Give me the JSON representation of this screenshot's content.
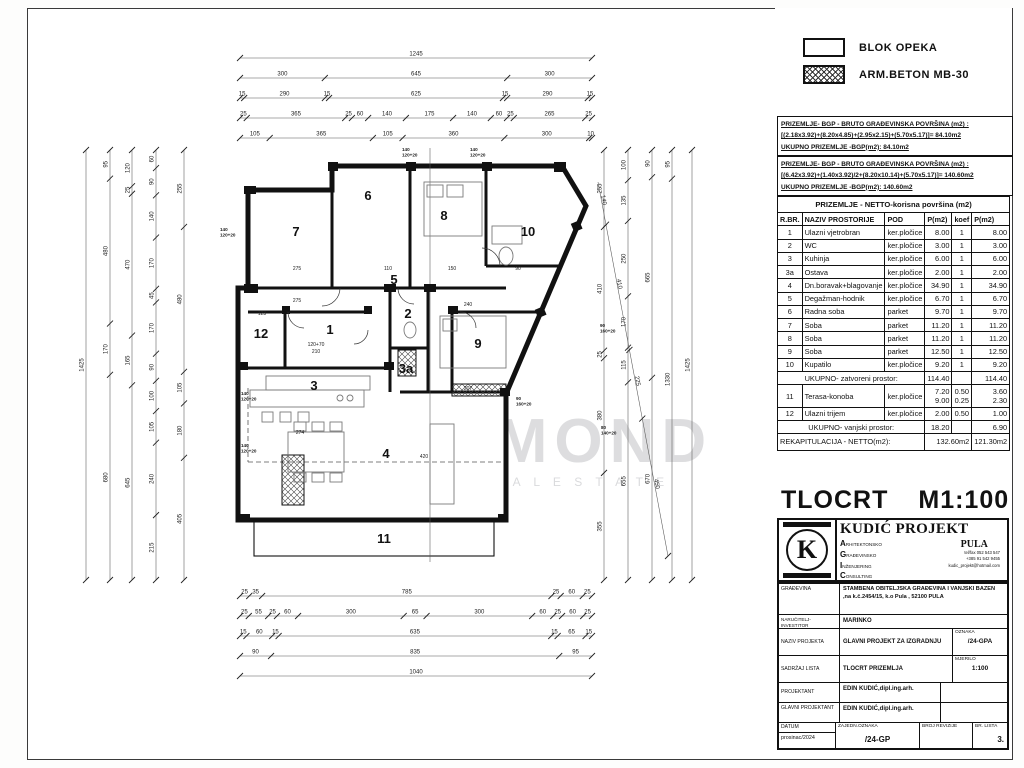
{
  "legend": {
    "items": [
      {
        "label": "BLOK OPEKA",
        "swatch": "plain"
      },
      {
        "label": "ARM.BETON  MB-30",
        "swatch": "hatch"
      }
    ]
  },
  "bgp1": {
    "l1": "PRIZEMLJE- BGP - BRUTO GRAĐEVINSKA POVRŠINA (m2) :",
    "l2": "[(2.18x3.92)+(8.20x4.85)+(2.95x2.15)+(5.70x5.17)]= 84.10m2",
    "l3": "UKUPNO PRIZEMLJE -BGP(m2):          84.10m2"
  },
  "bgp2": {
    "l1": "PRIZEMLJE- BGP - BRUTO GRAĐEVINSKA POVRŠINA (m2) :",
    "l2": "[(6.42x3.92)+(1.40x3.92)/2+(8.20x10.14)+(5.70x5.17)]= 140.60m2",
    "l3": "UKUPNO PRIZEMLJE -BGP(m2):          140.60m2"
  },
  "area_table": {
    "title": "PRIZEMLJE - NETTO-korisna površina (m2)",
    "columns": [
      "R.BR.",
      "NAZIV PROSTORIJE",
      "POD",
      "P(m2)",
      "koef",
      "P(m2)"
    ],
    "rows": [
      [
        "1",
        "Ulazni vjetrobran",
        "ker.pločice",
        "8.00",
        "1",
        "8.00"
      ],
      [
        "2",
        "WC",
        "ker.pločice",
        "3.00",
        "1",
        "3.00"
      ],
      [
        "3",
        "Kuhinja",
        "ker.pločice",
        "6.00",
        "1",
        "6.00"
      ],
      [
        "3a",
        "Ostava",
        "ker.pločice",
        "2.00",
        "1",
        "2.00"
      ],
      [
        "4",
        "Dn.boravak+blagovanje",
        "ker.pločice",
        "34.90",
        "1",
        "34.90"
      ],
      [
        "5",
        "Degažman-hodnik",
        "ker.pločice",
        "6.70",
        "1",
        "6.70"
      ],
      [
        "6",
        "Radna soba",
        "parket",
        "9.70",
        "1",
        "9.70"
      ],
      [
        "7",
        "Soba",
        "parket",
        "11.20",
        "1",
        "11.20"
      ],
      [
        "8",
        "Soba",
        "parket",
        "11.20",
        "1",
        "11.20"
      ],
      [
        "9",
        "Soba",
        "parket",
        "12.50",
        "1",
        "12.50"
      ],
      [
        "10",
        "Kupatilo",
        "ker.pločice",
        "9.20",
        "1",
        "9.20"
      ]
    ],
    "subtotal_closed": {
      "label": "UKUPNO- zatvoreni prostor:",
      "p": "114.40",
      "total": "114.40"
    },
    "outdoor_rows": [
      [
        "11",
        "Terasa-konoba",
        "ker.pločice",
        "7.20\n9.00",
        "0.50\n0.25",
        "3.60\n2.30"
      ],
      [
        "12",
        "Ulazni trijem",
        "ker.pločice",
        "2.00",
        "0.50",
        "1.00"
      ]
    ],
    "subtotal_outdoor": {
      "label": "UKUPNO- vanjski prostor:",
      "p": "18.20",
      "total": "6.90"
    },
    "recap": {
      "label": "REKAPITULACIJA - NETTO(m2):",
      "p": "132.60m2",
      "total": "121.30m2"
    }
  },
  "drawing_title": {
    "name": "TLOCRT",
    "scale": "M1:100"
  },
  "stamp": {
    "company": "KUDIĆ PROJEKT",
    "city": "PULA",
    "agic": [
      [
        "A",
        "RHITEKTONSKO"
      ],
      [
        "G",
        "RAĐEVINSKO"
      ],
      [
        "I",
        "NŽENJERING"
      ],
      [
        "C",
        "ONSULTING"
      ]
    ],
    "note1": "d.o.o. za projektiranje,",
    "note2": "nadzor i consulting",
    "contact": [
      "tel/fax 052 543 547",
      "+385 91 542 9455",
      "kudic_projekt@hotmail.com"
    ]
  },
  "title_block": {
    "rows": [
      {
        "label": "GRAĐEVINA",
        "value": "STAMBENA OBITELJSKA  GRAĐEVINA I VANJSKI BAZEN ,na k.č.2454/15, k.o Pula , 52100 PULA"
      },
      {
        "label": "NARUČITELJ-INVESTITOR",
        "value": "MARINKO"
      },
      {
        "label": "NAZIV PROJEKTA",
        "value": "GLAVNI PROJEKT ZA IZGRADNJU",
        "sub_label": "OZNAKA",
        "sub_value": "/24-GPA"
      },
      {
        "label": "SADRŽAJ LISTA",
        "value": "TLOCRT PRIZEMLJA",
        "sub_label": "MJERILO",
        "sub_value": "1:100"
      },
      {
        "label": "PROJEKTANT",
        "value": "EDIN KUDIĆ,dipl.ing.arh."
      },
      {
        "label": "GLAVNI PROJEKTANT",
        "value": "EDIN KUDIĆ,dipl.ing.arh."
      }
    ],
    "footer": {
      "label": "DATUM",
      "value": "prosinac/2024",
      "c1_label": "ZAJEDN.OZNAKA",
      "c1_value": "/24-GP",
      "c2_label": "BROJ REVIZIJE",
      "c2_value": "",
      "c3_label": "BR. LISTA",
      "c3_value": "3."
    }
  },
  "plan": {
    "watermark": "DIAMOND",
    "watermark_sub": "R E A L   E S T A T E",
    "rooms": [
      {
        "t": "7",
        "x": 296,
        "y": 236
      },
      {
        "t": "6",
        "x": 368,
        "y": 200
      },
      {
        "t": "8",
        "x": 444,
        "y": 220
      },
      {
        "t": "10",
        "x": 528,
        "y": 236
      },
      {
        "t": "5",
        "x": 394,
        "y": 284
      },
      {
        "t": "12",
        "x": 261,
        "y": 338
      },
      {
        "t": "1",
        "x": 330,
        "y": 334
      },
      {
        "t": "2",
        "x": 408,
        "y": 318
      },
      {
        "t": "9",
        "x": 478,
        "y": 348
      },
      {
        "t": "3a",
        "x": 406,
        "y": 373
      },
      {
        "t": "3",
        "x": 314,
        "y": 390
      },
      {
        "t": "4",
        "x": 386,
        "y": 458
      },
      {
        "t": "11",
        "x": 384,
        "y": 543
      }
    ],
    "window_labels": [
      {
        "l1": "140",
        "l2": "120+20",
        "x": 220,
        "y": 231
      },
      {
        "l1": "140",
        "l2": "120+20",
        "x": 241,
        "y": 395
      },
      {
        "l1": "140",
        "l2": "120+20",
        "x": 241,
        "y": 447
      },
      {
        "l1": "90",
        "l2": "160+20",
        "x": 600,
        "y": 327
      },
      {
        "l1": "80",
        "l2": "140+20",
        "x": 601,
        "y": 429
      },
      {
        "l1": "90",
        "l2": "160+20",
        "x": 516,
        "y": 400
      },
      {
        "l1": "140",
        "l2": "120+20",
        "x": 402,
        "y": 151
      },
      {
        "l1": "140",
        "l2": "120+20",
        "x": 470,
        "y": 151
      }
    ],
    "notes": [
      {
        "t": "275",
        "x": 297,
        "y": 270
      },
      {
        "t": "275",
        "x": 297,
        "y": 302
      },
      {
        "t": "110",
        "x": 388,
        "y": 270
      },
      {
        "t": "150",
        "x": 452,
        "y": 270
      },
      {
        "t": "90",
        "x": 518,
        "y": 270
      },
      {
        "t": "240",
        "x": 468,
        "y": 306
      },
      {
        "t": "123",
        "x": 262,
        "y": 315
      },
      {
        "t": "120+70",
        "x": 316,
        "y": 346
      },
      {
        "t": "210",
        "x": 316,
        "y": 353
      },
      {
        "t": "274",
        "x": 300,
        "y": 434
      },
      {
        "t": "207",
        "x": 468,
        "y": 390
      },
      {
        "t": "420",
        "x": 424,
        "y": 458
      }
    ],
    "dim_chains": [
      {
        "o": "h",
        "pos": 58,
        "from": 240,
        "span": 352,
        "values": [
          "1245"
        ]
      },
      {
        "o": "h",
        "pos": 78,
        "from": 240,
        "span": 352,
        "values": [
          "300",
          "645",
          "300"
        ]
      },
      {
        "o": "h",
        "pos": 98,
        "from": 240,
        "span": 352,
        "values": [
          "15",
          "290",
          "15",
          "625",
          "15",
          "290",
          "15"
        ]
      },
      {
        "o": "h",
        "pos": 118,
        "from": 240,
        "span": 352,
        "values": [
          "25",
          "365",
          "25",
          "60",
          "140",
          "175",
          "140",
          "60",
          "25",
          "265",
          "25"
        ]
      },
      {
        "o": "h",
        "pos": 138,
        "from": 240,
        "span": 352,
        "values": [
          "105",
          "365",
          "105",
          "360",
          "300",
          "10"
        ]
      },
      {
        "o": "h",
        "pos": 596,
        "from": 240,
        "span": 352,
        "values": [
          "25",
          "35",
          "785",
          "25",
          "60",
          "25"
        ]
      },
      {
        "o": "h",
        "pos": 616,
        "from": 240,
        "span": 352,
        "values": [
          "25",
          "55",
          "25",
          "60",
          "300",
          "65",
          "300",
          "60",
          "25",
          "60",
          "25"
        ]
      },
      {
        "o": "h",
        "pos": 636,
        "from": 240,
        "span": 352,
        "values": [
          "15",
          "60",
          "15",
          "635",
          "15",
          "65",
          "15"
        ]
      },
      {
        "o": "h",
        "pos": 656,
        "from": 240,
        "span": 352,
        "values": [
          "90",
          "835",
          "95"
        ]
      },
      {
        "o": "h",
        "pos": 676,
        "from": 240,
        "span": 352,
        "values": [
          "1040"
        ]
      },
      {
        "o": "v",
        "pos": 86,
        "from": 150,
        "span": 430,
        "values": [
          "1425"
        ]
      },
      {
        "o": "v",
        "pos": 110,
        "from": 150,
        "span": 430,
        "values": [
          "95",
          "480",
          "170",
          "680"
        ]
      },
      {
        "o": "v",
        "pos": 132,
        "from": 150,
        "span": 430,
        "values": [
          "120",
          "25",
          "470",
          "165",
          "645"
        ]
      },
      {
        "o": "v",
        "pos": 156,
        "from": 150,
        "span": 430,
        "values": [
          "60",
          "90",
          "140",
          "170",
          "45",
          "170",
          "90",
          "100",
          "105",
          "240",
          "215"
        ]
      },
      {
        "o": "v",
        "pos": 184,
        "from": 150,
        "span": 430,
        "values": [
          "255",
          "480",
          "105",
          "180",
          "405"
        ]
      },
      {
        "o": "v",
        "pos": 604,
        "from": 150,
        "span": 430,
        "values": [
          "255",
          "410",
          "25",
          "380",
          "355"
        ]
      },
      {
        "o": "v",
        "pos": 628,
        "from": 150,
        "span": 430,
        "values": [
          "100",
          "135",
          "250",
          "170",
          "115",
          "655"
        ]
      },
      {
        "o": "v",
        "pos": 652,
        "from": 150,
        "span": 430,
        "values": [
          "90",
          "665",
          "670"
        ]
      },
      {
        "o": "v",
        "pos": 672,
        "from": 150,
        "span": 430,
        "values": [
          "95",
          "1330"
        ]
      },
      {
        "o": "v",
        "pos": 692,
        "from": 150,
        "span": 430,
        "values": [
          "1425"
        ]
      },
      {
        "o": "d",
        "x1": 598,
        "y1": 182,
        "x2": 668,
        "y2": 556,
        "values": [
          "140",
          "410",
          "225",
          "450"
        ]
      }
    ]
  }
}
